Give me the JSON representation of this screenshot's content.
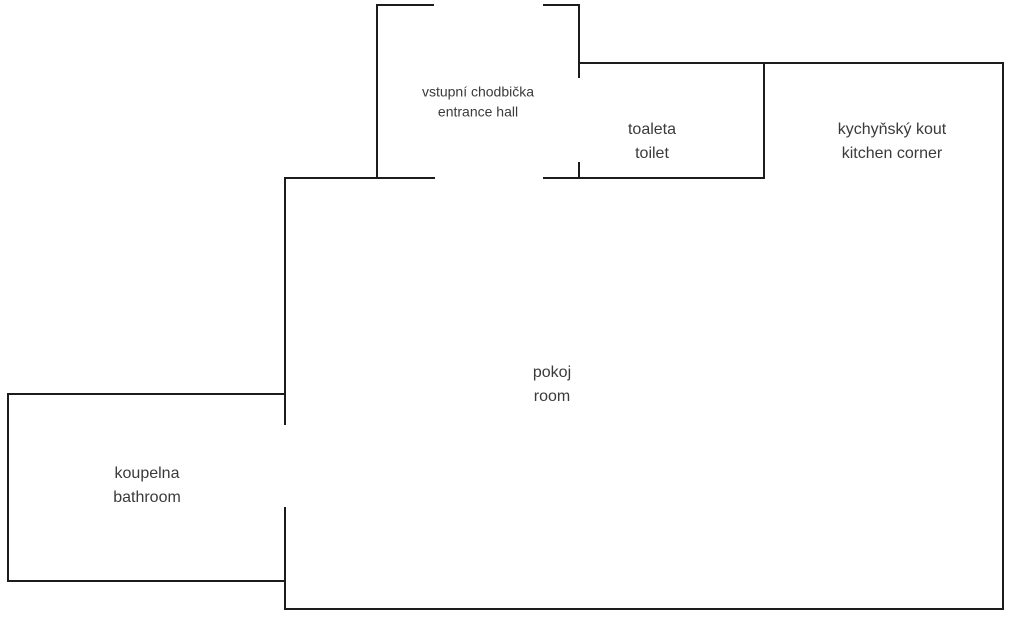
{
  "diagram": {
    "type": "floor-plan",
    "canvas": {
      "width": 1010,
      "height": 620,
      "background": "#ffffff"
    },
    "colors": {
      "wall": "#1c1c1c",
      "label_text": "#3a3a3a"
    },
    "wall_thickness": 2
  },
  "rooms": [
    {
      "id": "entrance-hall",
      "name_cs": "vstupní chodbička",
      "name_en": "entrance hall",
      "label_x": 478,
      "label_y": 102
    },
    {
      "id": "toilet",
      "name_cs": "toaleta",
      "name_en": "toilet",
      "label_x": 652,
      "label_y": 142
    },
    {
      "id": "kitchen-corner",
      "name_cs": "kychyňský kout",
      "name_en": "kitchen corner",
      "label_x": 892,
      "label_y": 142
    },
    {
      "id": "room",
      "name_cs": "pokoj",
      "name_en": "room",
      "label_x": 552,
      "label_y": 385
    },
    {
      "id": "bathroom",
      "name_cs": "koupelna",
      "name_en": "bathroom",
      "label_x": 147,
      "label_y": 486
    }
  ],
  "walls": {
    "horizontal": [
      {
        "name": "hall-top-wall-left",
        "y": 4,
        "x1": 376,
        "x2": 434
      },
      {
        "name": "hall-top-wall-right",
        "y": 4,
        "x1": 543,
        "x2": 580
      },
      {
        "name": "toilet-kitchen-top-wall",
        "y": 62,
        "x1": 578,
        "x2": 1004
      },
      {
        "name": "room-top-wall-left",
        "y": 177,
        "x1": 284,
        "x2": 435
      },
      {
        "name": "toilet-bottom-wall",
        "y": 177,
        "x1": 543,
        "x2": 765
      },
      {
        "name": "bathroom-top-wall",
        "y": 393,
        "x1": 7,
        "x2": 286
      },
      {
        "name": "bathroom-bottom-wall",
        "y": 580,
        "x1": 7,
        "x2": 286
      },
      {
        "name": "room-bottom-wall",
        "y": 608,
        "x1": 284,
        "x2": 1004
      }
    ],
    "vertical": [
      {
        "name": "hall-left-wall",
        "x": 376,
        "y1": 4,
        "y2": 179
      },
      {
        "name": "hall-toilet-wall-upper",
        "x": 578,
        "y1": 4,
        "y2": 78
      },
      {
        "name": "hall-toilet-wall-lower",
        "x": 578,
        "y1": 162,
        "y2": 179
      },
      {
        "name": "toilet-right-wall",
        "x": 763,
        "y1": 62,
        "y2": 179
      },
      {
        "name": "right-outer-wall",
        "x": 1002,
        "y1": 62,
        "y2": 610
      },
      {
        "name": "room-left-wall-upper",
        "x": 284,
        "y1": 177,
        "y2": 425
      },
      {
        "name": "room-left-wall-lower",
        "x": 284,
        "y1": 507,
        "y2": 610
      },
      {
        "name": "bathroom-left-wall",
        "x": 7,
        "y1": 393,
        "y2": 582
      }
    ]
  }
}
